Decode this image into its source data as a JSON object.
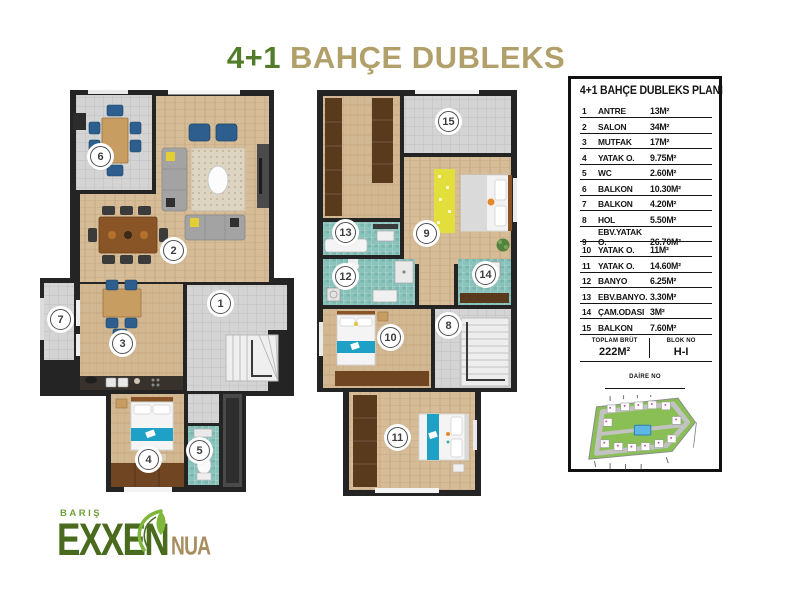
{
  "title": {
    "prefix": "4+1",
    "rest": "BAHÇE DUBLEKS"
  },
  "legend": {
    "header": "4+1 BAHÇE DUBLEKS PLANI",
    "rows": [
      {
        "no": "1",
        "name": "ANTRE",
        "area": "13M²"
      },
      {
        "no": "2",
        "name": "SALON",
        "area": "34M²"
      },
      {
        "no": "3",
        "name": "MUTFAK",
        "area": "17M²"
      },
      {
        "no": "4",
        "name": "YATAK O.",
        "area": "9.75M²"
      },
      {
        "no": "5",
        "name": "WC",
        "area": "2.60M²"
      },
      {
        "no": "6",
        "name": "BALKON",
        "area": "10.30M²"
      },
      {
        "no": "7",
        "name": "BALKON",
        "area": "4.20M²"
      },
      {
        "no": "8",
        "name": "HOL",
        "area": "5.50M²"
      },
      {
        "no": "9",
        "name": "EBV.YATAK O.",
        "area": "26.70M²"
      },
      {
        "no": "10",
        "name": "YATAK O.",
        "area": "11M²"
      },
      {
        "no": "11",
        "name": "YATAK O.",
        "area": "14.60M²"
      },
      {
        "no": "12",
        "name": "BANYO",
        "area": "6.25M²"
      },
      {
        "no": "13",
        "name": "EBV.BANYO.",
        "area": "3.30M²"
      },
      {
        "no": "14",
        "name": "ÇAM.ODASI",
        "area": "3M²"
      },
      {
        "no": "15",
        "name": "BALKON",
        "area": "7.60M²"
      }
    ],
    "totals": {
      "toplam_label": "TOPLAM BRÜT",
      "toplam_value": "222M²",
      "blok_label": "BLOK NO",
      "blok_value": "H-I",
      "daire_label": "DAİRE NO"
    }
  },
  "logo": {
    "top": "BARIŞ",
    "main": "EXXEN",
    "sub": "NUA"
  },
  "colors": {
    "title_green": "#527c2a",
    "title_gold": "#b2a06b",
    "logo_green": "#4a6b1e",
    "logo_leaf_green": "#7eb73c",
    "logo_tan": "#a88d60",
    "wall": "#242424",
    "wood_floor": "#d6bd97",
    "tile_gray": "#d4d4d4",
    "bath_teal": "#8ac3bb",
    "bed_blue": "#1fa0c6",
    "chair_blue": "#2d5e8d"
  }
}
